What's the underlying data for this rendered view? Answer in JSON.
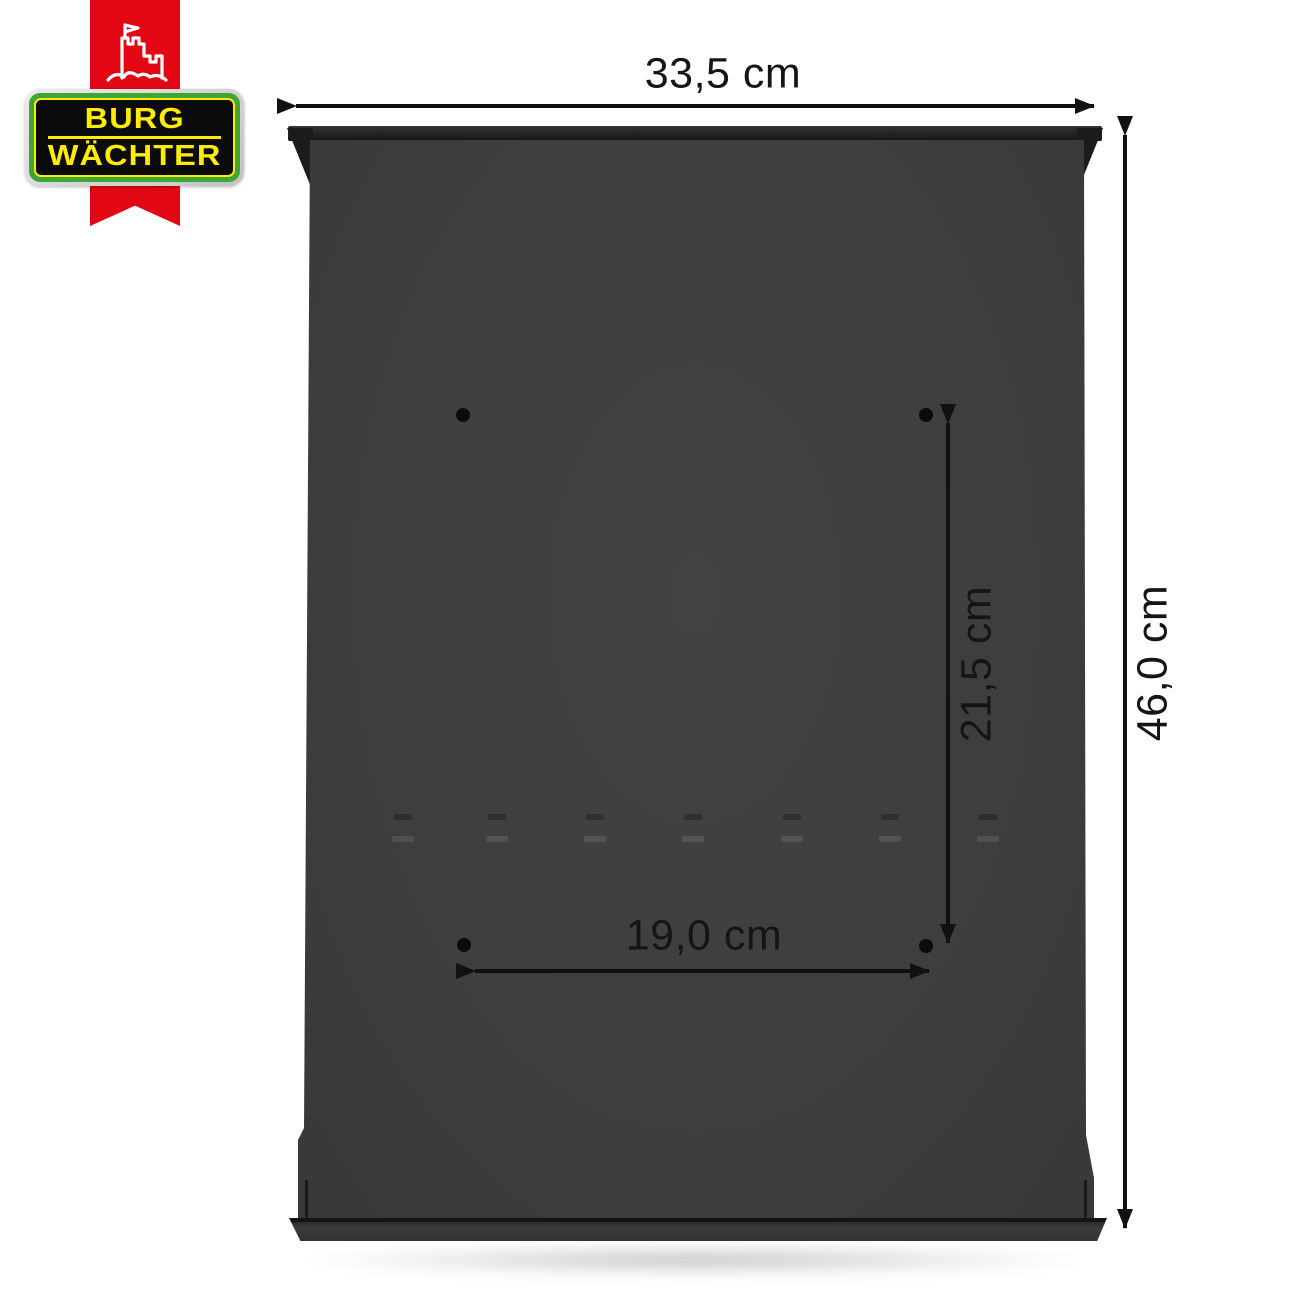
{
  "brand": {
    "logo_line1": "BURG",
    "logo_line2": "WÄCHTER",
    "castle_icon": "castle-with-flag",
    "colors": {
      "ribbon_red": "#e30613",
      "badge_green": "#3fa535",
      "badge_yellow": "#ffec00",
      "badge_black": "#0c0c0c"
    }
  },
  "product": {
    "body_color": "#3e3e3e",
    "mounting_hole_count": 4
  },
  "dimensions": {
    "width_label": "33,5 cm",
    "height_label": "46,0 cm",
    "hole_spacing_vertical_label": "21,5 cm",
    "hole_spacing_horizontal_label": "19,0 cm"
  }
}
